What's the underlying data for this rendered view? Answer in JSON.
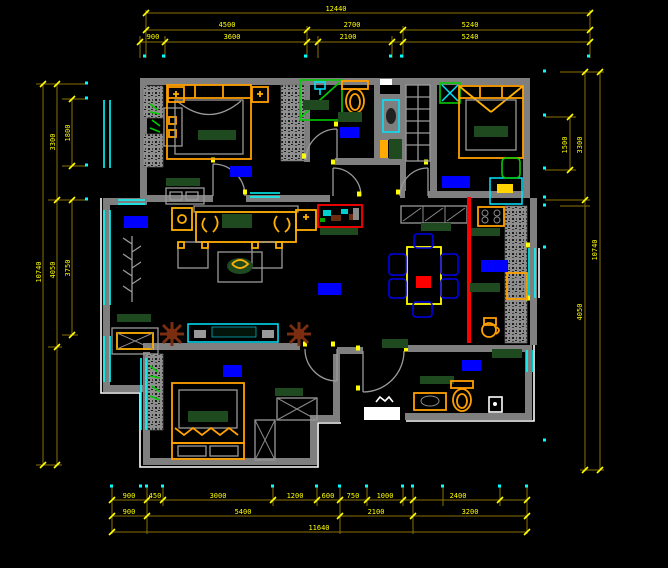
{
  "canvas": {
    "background": "#000000",
    "kind": "residential floor plan drawing"
  },
  "palette": {
    "wall_gray": "#7f7f7f",
    "dim_line": "#8a7000",
    "dim_text_yellow": "#ffff00",
    "window_cyan": "#00ffff",
    "label_blue": "#0000ff",
    "furniture_gold": "#ffb000",
    "bed_frame_orange": "#ffa000",
    "fabric_dark_green": "#1f4a1f",
    "accent_bright_green": "#00cc00",
    "highlight_red": "#ff0000",
    "plant_brown": "#7b2d10",
    "outline_white": "#ffffff"
  },
  "dimensions": {
    "top": {
      "overall": [
        "12440"
      ],
      "row2": [
        "4500",
        "2700",
        "5240"
      ],
      "row3": [
        "900",
        "3600",
        "2100",
        "5240"
      ]
    },
    "bottom": {
      "row1": [
        "900",
        "450",
        "3000",
        "1200",
        "600",
        "750",
        "1000",
        "2400"
      ],
      "row2": [
        "900",
        "5400",
        "2100",
        "3200"
      ],
      "overall": [
        "11640"
      ]
    },
    "left": {
      "inner": [
        "1800",
        "3750"
      ],
      "mid": [
        "3300",
        "4050"
      ],
      "overall": [
        "10740"
      ]
    },
    "right": {
      "inner": [
        "1500"
      ],
      "mid": [
        "3300",
        "4050"
      ],
      "overall": [
        "10740"
      ]
    }
  },
  "room_labels": [
    {
      "id": "bedroom-1",
      "color": "#0000ff"
    },
    {
      "id": "bathroom-1",
      "color": "#0000ff"
    },
    {
      "id": "bedroom-2",
      "color": "#0000ff"
    },
    {
      "id": "living-room",
      "color": "#0000ff"
    },
    {
      "id": "hallway",
      "color": "#0000ff"
    },
    {
      "id": "kitchen",
      "color": "#0000ff"
    },
    {
      "id": "bedroom-3",
      "color": "#0000ff"
    },
    {
      "id": "bathroom-2",
      "color": "#0000ff"
    }
  ],
  "furniture_icons": [
    "canopy-double-bed",
    "nightstand-lamp",
    "wardrobe-hatched",
    "dresser",
    "bench-table",
    "shower-cabin",
    "shower-head",
    "toilet",
    "washbasin-column",
    "shelf-cabinet",
    "ceiling-fan",
    "double-bed-canopy-x",
    "desk",
    "desk-chair",
    "sofa-set",
    "side-table-lamp",
    "armchair",
    "coffee-table-plant",
    "tv-cabinet",
    "potted-plant",
    "coat-branch",
    "balcony-table",
    "single-bed-drawers",
    "x-wardrobe",
    "dining-table",
    "dining-chair",
    "sideboard",
    "gas-stove",
    "kitchen-counter-hatched",
    "sink-cabinet",
    "kettle",
    "shoe-cabinet",
    "washbasin",
    "paper-holder",
    "entry-landing",
    "door-swing-arc",
    "window-double-line"
  ]
}
